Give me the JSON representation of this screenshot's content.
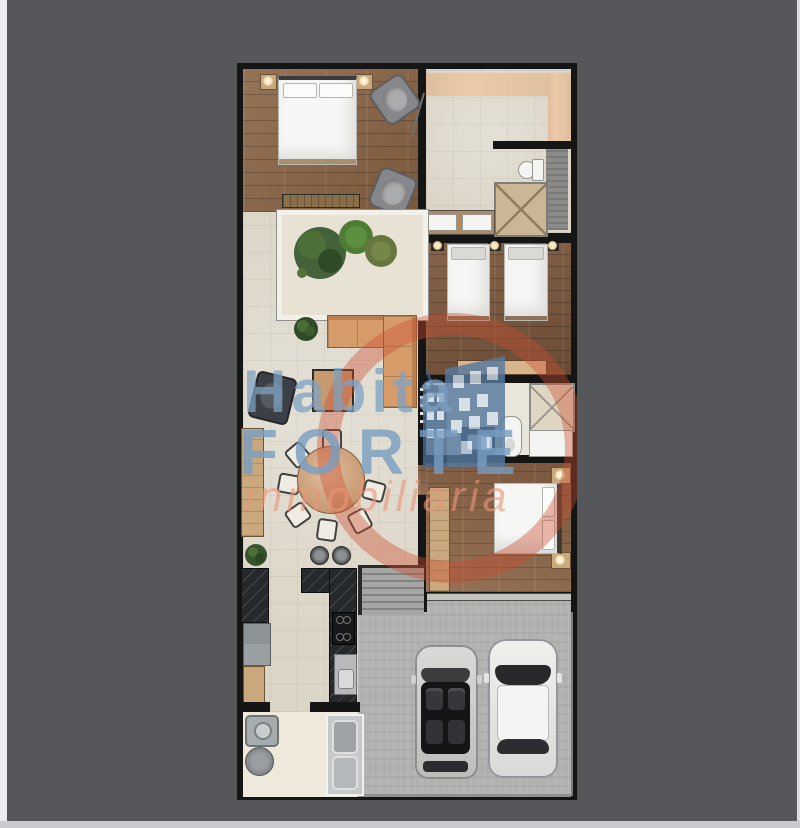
{
  "watermark": {
    "line1": "Habita",
    "line2": "FORTE",
    "line3": "inmobiliaria",
    "circle_color": "#ca4e30",
    "text_blue": "#7a9ec0",
    "text_salmon": "#e8967a",
    "icon": "building-icon"
  },
  "colors": {
    "viewer_background": "#55575a",
    "page_edge": "#ebecf0",
    "wall": "#151515",
    "wood_master": "#8a6444",
    "wood_twin": "#7c573c",
    "wood_bedroom3": "#8b6345",
    "tile_cream": "#dcd6c8",
    "corridor_peach": "#ecc9a8",
    "sofa_tan": "#d59c69",
    "kitchen_granite": "#26292c",
    "garage_concrete": "#b1b1af"
  },
  "plan": {
    "rooms": [
      "master-bedroom",
      "entry-hall",
      "bathroom-1",
      "courtyard",
      "twin-bedroom",
      "living-room",
      "dining-area",
      "bathroom-2",
      "bedroom-3",
      "kitchen",
      "laundry-room",
      "stairs",
      "garage"
    ],
    "furniture": [
      "double-bed",
      "armchairs",
      "bench",
      "twin-beds",
      "l-shaped-sofa",
      "ottoman",
      "lounge-chair",
      "round-dining-table",
      "dining-chairs",
      "bar-stools",
      "stove",
      "kitchen-sink",
      "refrigerator",
      "washer",
      "laundry-sink",
      "toilets",
      "showers",
      "vanities",
      "wardrobe",
      "two-cars",
      "plants"
    ]
  }
}
